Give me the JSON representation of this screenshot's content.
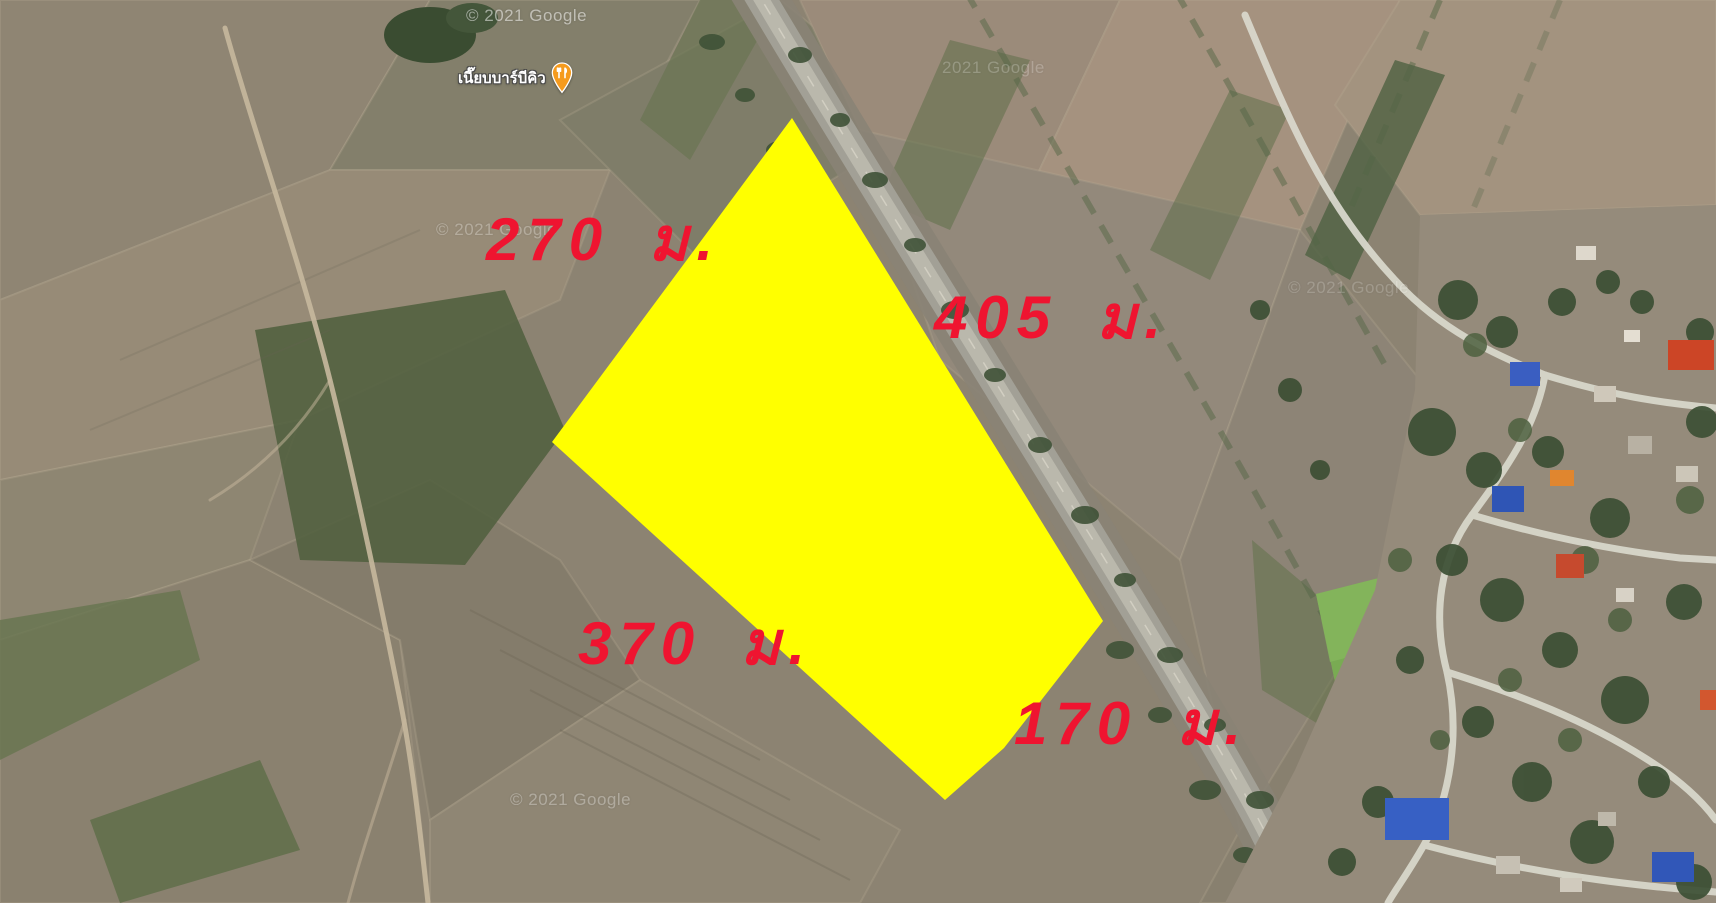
{
  "window": {
    "view": "satellite-map",
    "width_px": 1716,
    "height_px": 903
  },
  "map_overlay": {
    "plot": {
      "fill_color": "#FFFF00",
      "points": [
        [
          792,
          118
        ],
        [
          1103,
          621
        ],
        [
          1004,
          748
        ],
        [
          945,
          800
        ],
        [
          552,
          442
        ]
      ]
    },
    "label_color": "#EF1430",
    "side_labels": [
      {
        "position": "northwest",
        "text": "270 ม.",
        "x": 486,
        "y": 210
      },
      {
        "position": "northeast",
        "text": "405 ม.",
        "x": 934,
        "y": 288
      },
      {
        "position": "southwest",
        "text": "370 ม.",
        "x": 578,
        "y": 614
      },
      {
        "position": "southeast",
        "text": "170 ม.",
        "x": 1014,
        "y": 694
      }
    ]
  },
  "poi": {
    "name": "เนี๊ยบบาร์บีคิว",
    "icon": "restaurant-pin",
    "pin_color": "#F59B1E",
    "x": 458,
    "y": 62
  },
  "watermarks": [
    {
      "text": "© 2021 Google",
      "x": 466,
      "y": 6,
      "opacity": 0.5
    },
    {
      "text": "2021 Google",
      "x": 942,
      "y": 58,
      "opacity": 0.22
    },
    {
      "text": "© 2021 Google",
      "x": 436,
      "y": 220,
      "opacity": 0.28
    },
    {
      "text": "© 2021 Google",
      "x": 1288,
      "y": 278,
      "opacity": 0.18
    },
    {
      "text": "© 2021 Google",
      "x": 510,
      "y": 790,
      "opacity": 0.3
    }
  ]
}
